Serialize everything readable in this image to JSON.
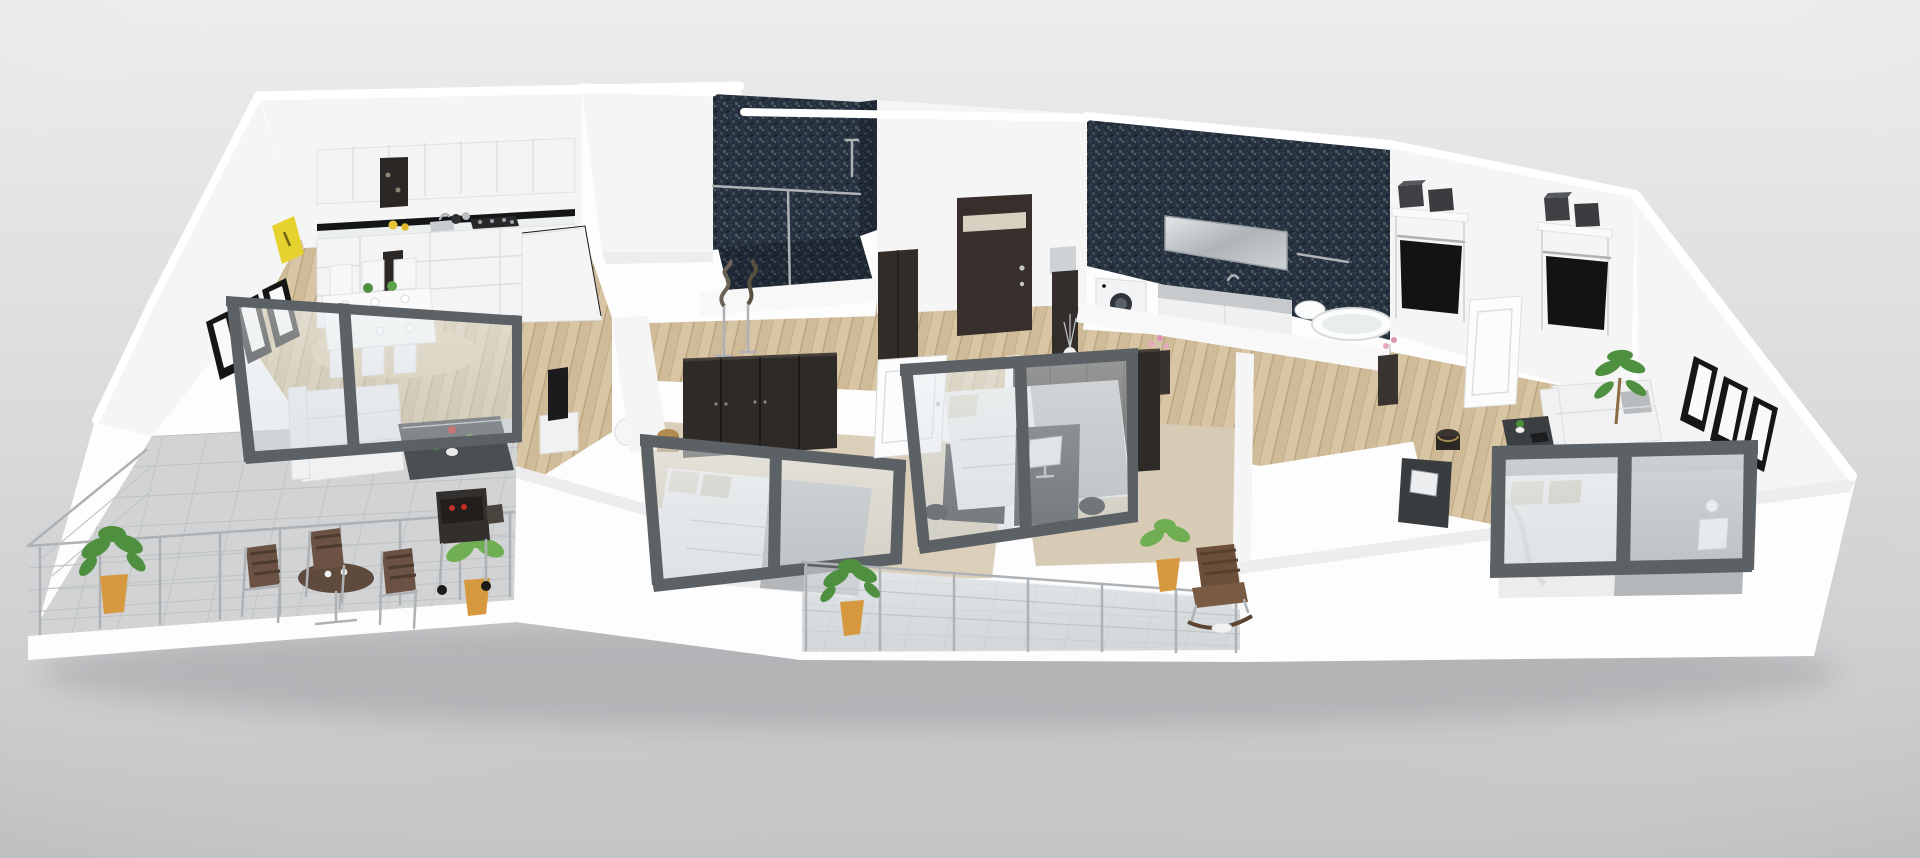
{
  "meta": {
    "description": "3D rendered isometric floor plan of a modern apartment with kitchen, living room, dining area, two bathrooms, three bedrooms, walk-in closet, large terrace and balcony",
    "style": "photorealistic 3D render on neutral studio backdrop",
    "no_visible_text": true
  },
  "palette": {
    "backdrop_top": "#eceded",
    "backdrop_bottom": "#c2c3c5",
    "wall_white": "#f5f5f6",
    "wall_bright": "#fdfdfe",
    "mosaic_base": "#273140",
    "wood_base": "#d8c5a4",
    "tile_base": "#d1d3d4",
    "carpet_base": "#dbcfba",
    "wardrobe_dark": "#2e2a27",
    "entry_door_dark": "#362f2b",
    "glass_frame": "#5c6165",
    "glass_tint": "#dfe6e9",
    "plant_green": "#4e9040",
    "plant_green_light": "#6fae52",
    "pot_orange": "#d6993f",
    "accent_yellow": "#e6d22e",
    "sofa_white": "#f1f1f2",
    "bed_gray": "#b4b7ba",
    "table_brown": "#5f4a3e",
    "rug_tan": "#dbc9a6",
    "metal_gray": "#aeb2b5"
  },
  "rooms": [
    {
      "id": "terrace",
      "label": "terrace",
      "furniture": [
        "round bistro table",
        "4 metal-frame chairs",
        "2 potted plants",
        "bbq grill",
        "cable railing"
      ]
    },
    {
      "id": "living-room",
      "label": "living room",
      "furniture": [
        "white sofa",
        "dark glass coffee table with plants",
        "tv console",
        "sliding glass wall to terrace"
      ]
    },
    {
      "id": "dining-area",
      "label": "dining area",
      "furniture": [
        "white dining table",
        "6 white chairs",
        "round tan rug",
        "table settings"
      ]
    },
    {
      "id": "kitchen",
      "label": "kitchen",
      "furniture": [
        "white upper cabinets",
        "black backsplash strip",
        "gas hob",
        "sink",
        "white lower cabinets",
        "dark tall unit",
        "yellow counter items"
      ]
    },
    {
      "id": "shower-room",
      "label": "shower room",
      "furniture": [
        "navy mosaic walls",
        "walk-in shower",
        "glass screen"
      ]
    },
    {
      "id": "entrance-hall",
      "label": "entrance hall",
      "furniture": [
        "dark entry door with glass stripe",
        "tall dark cabinet",
        "console with round mirror and vase"
      ]
    },
    {
      "id": "hallway",
      "label": "hallway",
      "furniture": [
        "two decorative sculptures on stands",
        "orchid consoles"
      ]
    },
    {
      "id": "bathroom",
      "label": "bathroom",
      "furniture": [
        "navy mosaic feature wall",
        "wide mirror",
        "floating vanity with sink",
        "white under-cabinets",
        "washing machine",
        "toilet",
        "bathtub"
      ]
    },
    {
      "id": "walk-in-closet",
      "label": "walk-in closet",
      "furniture": [
        "two white shelving units",
        "dark storage boxes",
        "hanging black clothes",
        "white doors"
      ]
    },
    {
      "id": "bedroom-1",
      "label": "bedroom 1",
      "furniture": [
        "dark wardrobe",
        "double bed",
        "glass partition",
        "desk with computer",
        "brass stool",
        "white vase"
      ]
    },
    {
      "id": "bedroom-2",
      "label": "bedroom 2",
      "furniture": [
        "dark wardrobe",
        "double bed",
        "glass partition",
        "desk with monitor",
        "office chair"
      ]
    },
    {
      "id": "master-bedroom",
      "label": "master bedroom",
      "furniture": [
        "white sofa",
        "palm plant",
        "coffee table with laptop",
        "desk with monitor",
        "double bed with gray headboard",
        "glass partition",
        "nightstand with lamp",
        "side stool"
      ]
    },
    {
      "id": "balcony",
      "label": "balcony",
      "furniture": [
        "glass railing",
        "wicker rocking chair",
        "2 potted plants",
        "side table"
      ]
    }
  ],
  "wall_art": {
    "left_wall_frames": 3,
    "right_wall_frames": 3,
    "yellow_plaque": 1
  },
  "counts": {
    "potted_plants_total": 5,
    "glass_partitions": 4,
    "open_white_doors": 5,
    "sculptures": 2
  }
}
